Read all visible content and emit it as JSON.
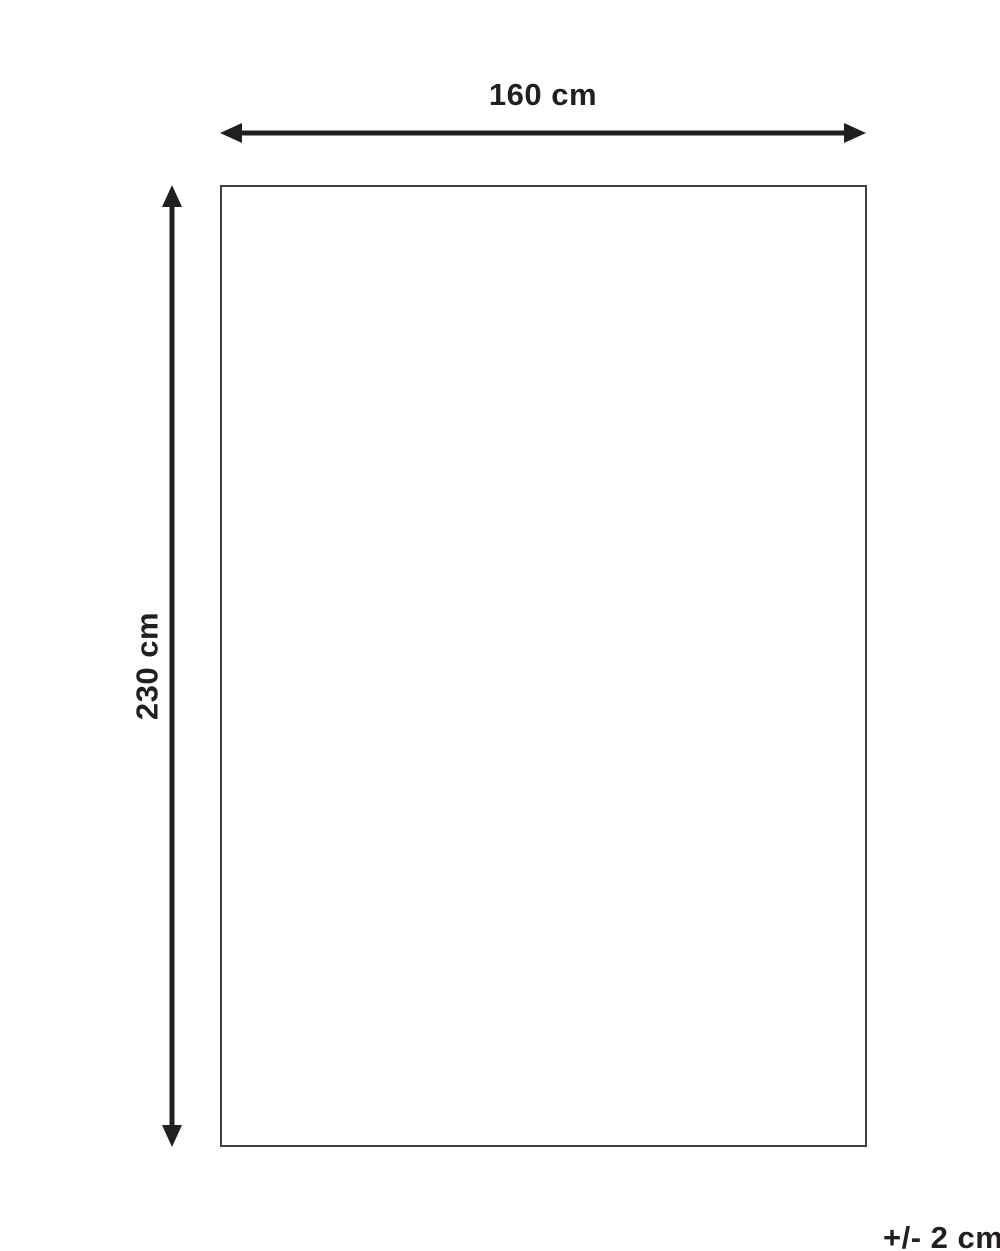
{
  "diagram": {
    "width_label": "160 cm",
    "height_label": "230 cm",
    "tolerance_label": "+/- 2 cm",
    "colors": {
      "line": "#231f20",
      "outline": "#404040",
      "background": "#ffffff"
    }
  }
}
